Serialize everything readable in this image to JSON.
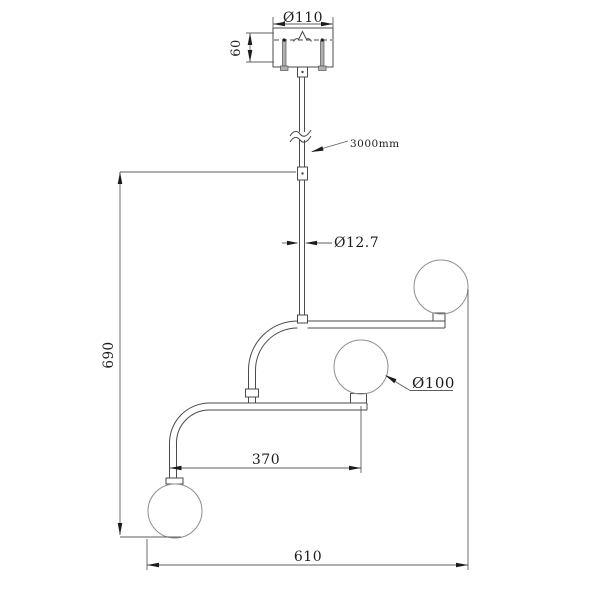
{
  "drawing": {
    "kind": "pendant-lamp-dimension-drawing",
    "background_color": "#ffffff",
    "line_color": "#4a4a4a",
    "dimension_line_color": "#5f5f5f",
    "text_color": "#1c1c1c",
    "labels": {
      "canopy_diameter": "Ø110",
      "canopy_height": "60",
      "suspension_length": "3000mm",
      "rod_diameter": "Ø12.7",
      "globe_diameter": "Ø100",
      "overall_drop": "690",
      "arm_spacing": "370",
      "overall_width": "610"
    },
    "parts": [
      "ceiling-canopy",
      "suspension-rod",
      "upper-arm",
      "lower-arm",
      "globe-top-right",
      "globe-middle",
      "globe-bottom-left"
    ]
  }
}
